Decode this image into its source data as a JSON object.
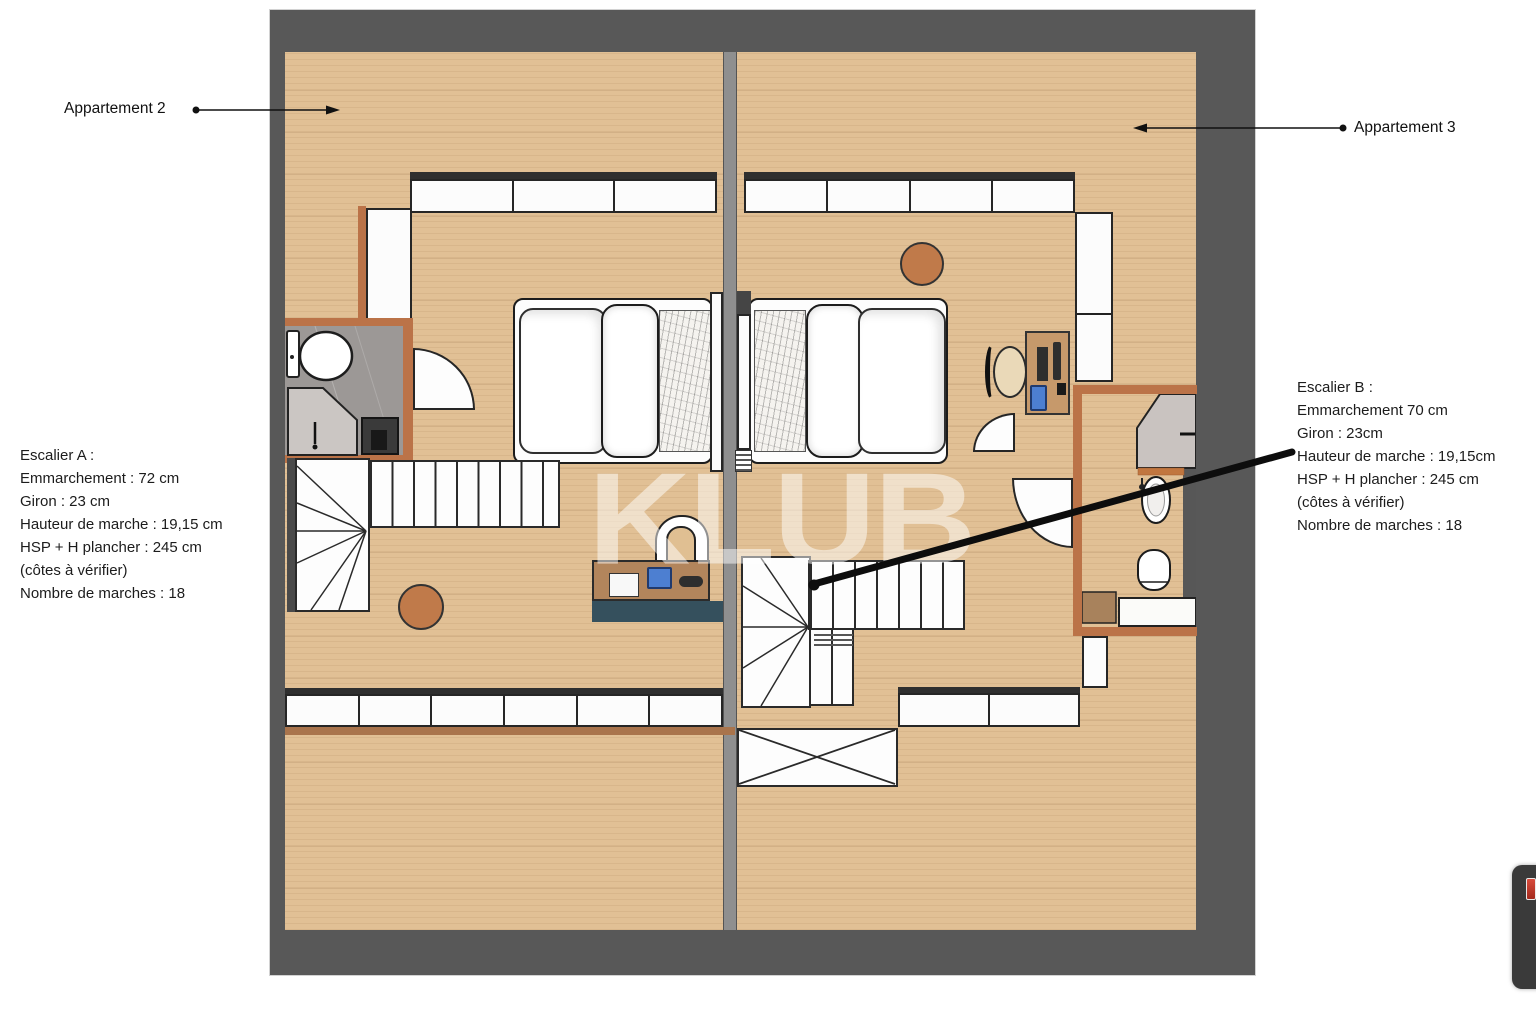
{
  "labels": {
    "apartment_2": "Appartement 2",
    "apartment_3": "Appartement 3"
  },
  "stair_a": {
    "title": "Escalier A :",
    "lines": [
      "Emmarchement : 72 cm",
      "Giron : 23 cm",
      "Hauteur de marche : 19,15 cm",
      "HSP + H plancher : 245 cm",
      "(côtes à vérifier)",
      "Nombre de marches : 18"
    ]
  },
  "stair_b": {
    "title": "Escalier B :",
    "lines": [
      "Emmarchement 70 cm",
      "Giron : 23cm",
      "Hauteur de marche : 19,15cm",
      "HSP + H plancher : 245 cm",
      "(côtes à vérifier)",
      "Nombre de marches : 18"
    ]
  },
  "watermark": "KLUB",
  "colors": {
    "outer_wall": "#585858",
    "divider_wall": "#8f8f8f",
    "interior_wall": "#bb7348",
    "floor_wood": "#e1c095",
    "bathroom_tile": "#9c9896",
    "furniture_wood": "#b2855c",
    "accent_blue": "#4d7fd1",
    "stool_brown": "#c07a4a",
    "rug_navy": "#35505d",
    "annotation": "#111111",
    "badge_red": "#c0392b"
  },
  "floating_button": {
    "icon": "red-badge-icon"
  }
}
